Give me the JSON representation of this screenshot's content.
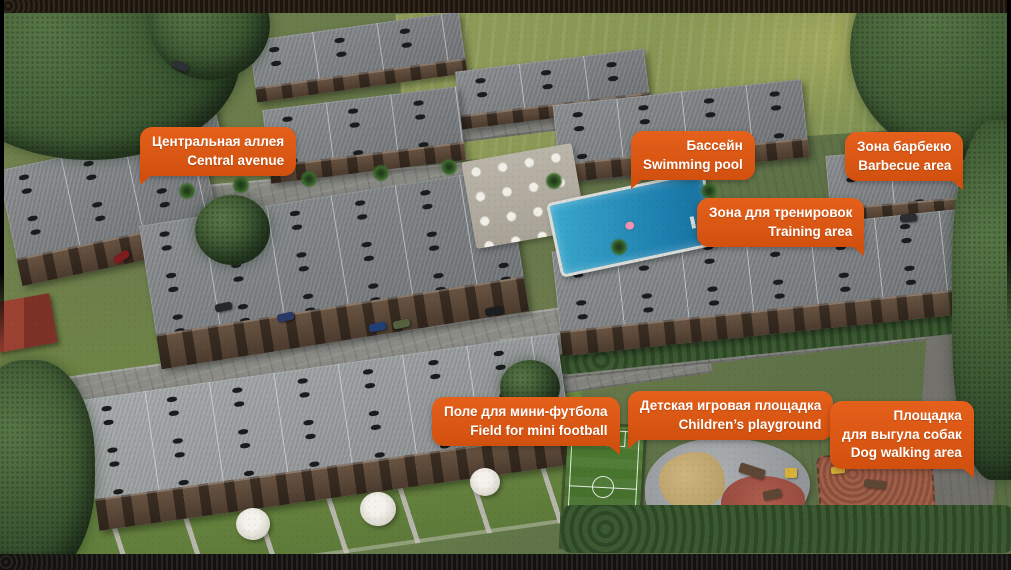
{
  "meta": {
    "description_label": "Residential complex aerial masterplan with amenity callouts"
  },
  "colors": {
    "label_bg_top": "#E4601B",
    "label_bg_bottom": "#D2500E",
    "label_text": "#FFFFFF",
    "grass_green": "#6D7F4A",
    "field_yellow_green": "#8F9C58",
    "roof_gray": "#7E8284",
    "road_gray": "#8F8F8A",
    "pool_blue": "#2391BC",
    "pitch_green": "#4A7A30",
    "dog_area_brown": "#9B5F4A"
  },
  "labels": [
    {
      "name": "central-avenue",
      "lines": [
        "Центральная аллея",
        "Central avenue"
      ]
    },
    {
      "name": "swimming-pool",
      "lines": [
        "Бассейн",
        "Swimming pool"
      ]
    },
    {
      "name": "barbecue-area",
      "lines": [
        "Зона барбекю",
        "Barbecue area"
      ]
    },
    {
      "name": "training-area",
      "lines": [
        "Зона для тренировок",
        "Training area"
      ]
    },
    {
      "name": "mini-football-field",
      "lines": [
        "Поле для мини-футбола",
        "Field for mini football"
      ]
    },
    {
      "name": "children-playground",
      "lines": [
        "Детская игровая площадка",
        "Children’s playground"
      ]
    },
    {
      "name": "dog-walking-area",
      "lines": [
        "Площадка",
        "для выгула собак",
        "Dog walking area"
      ]
    }
  ]
}
